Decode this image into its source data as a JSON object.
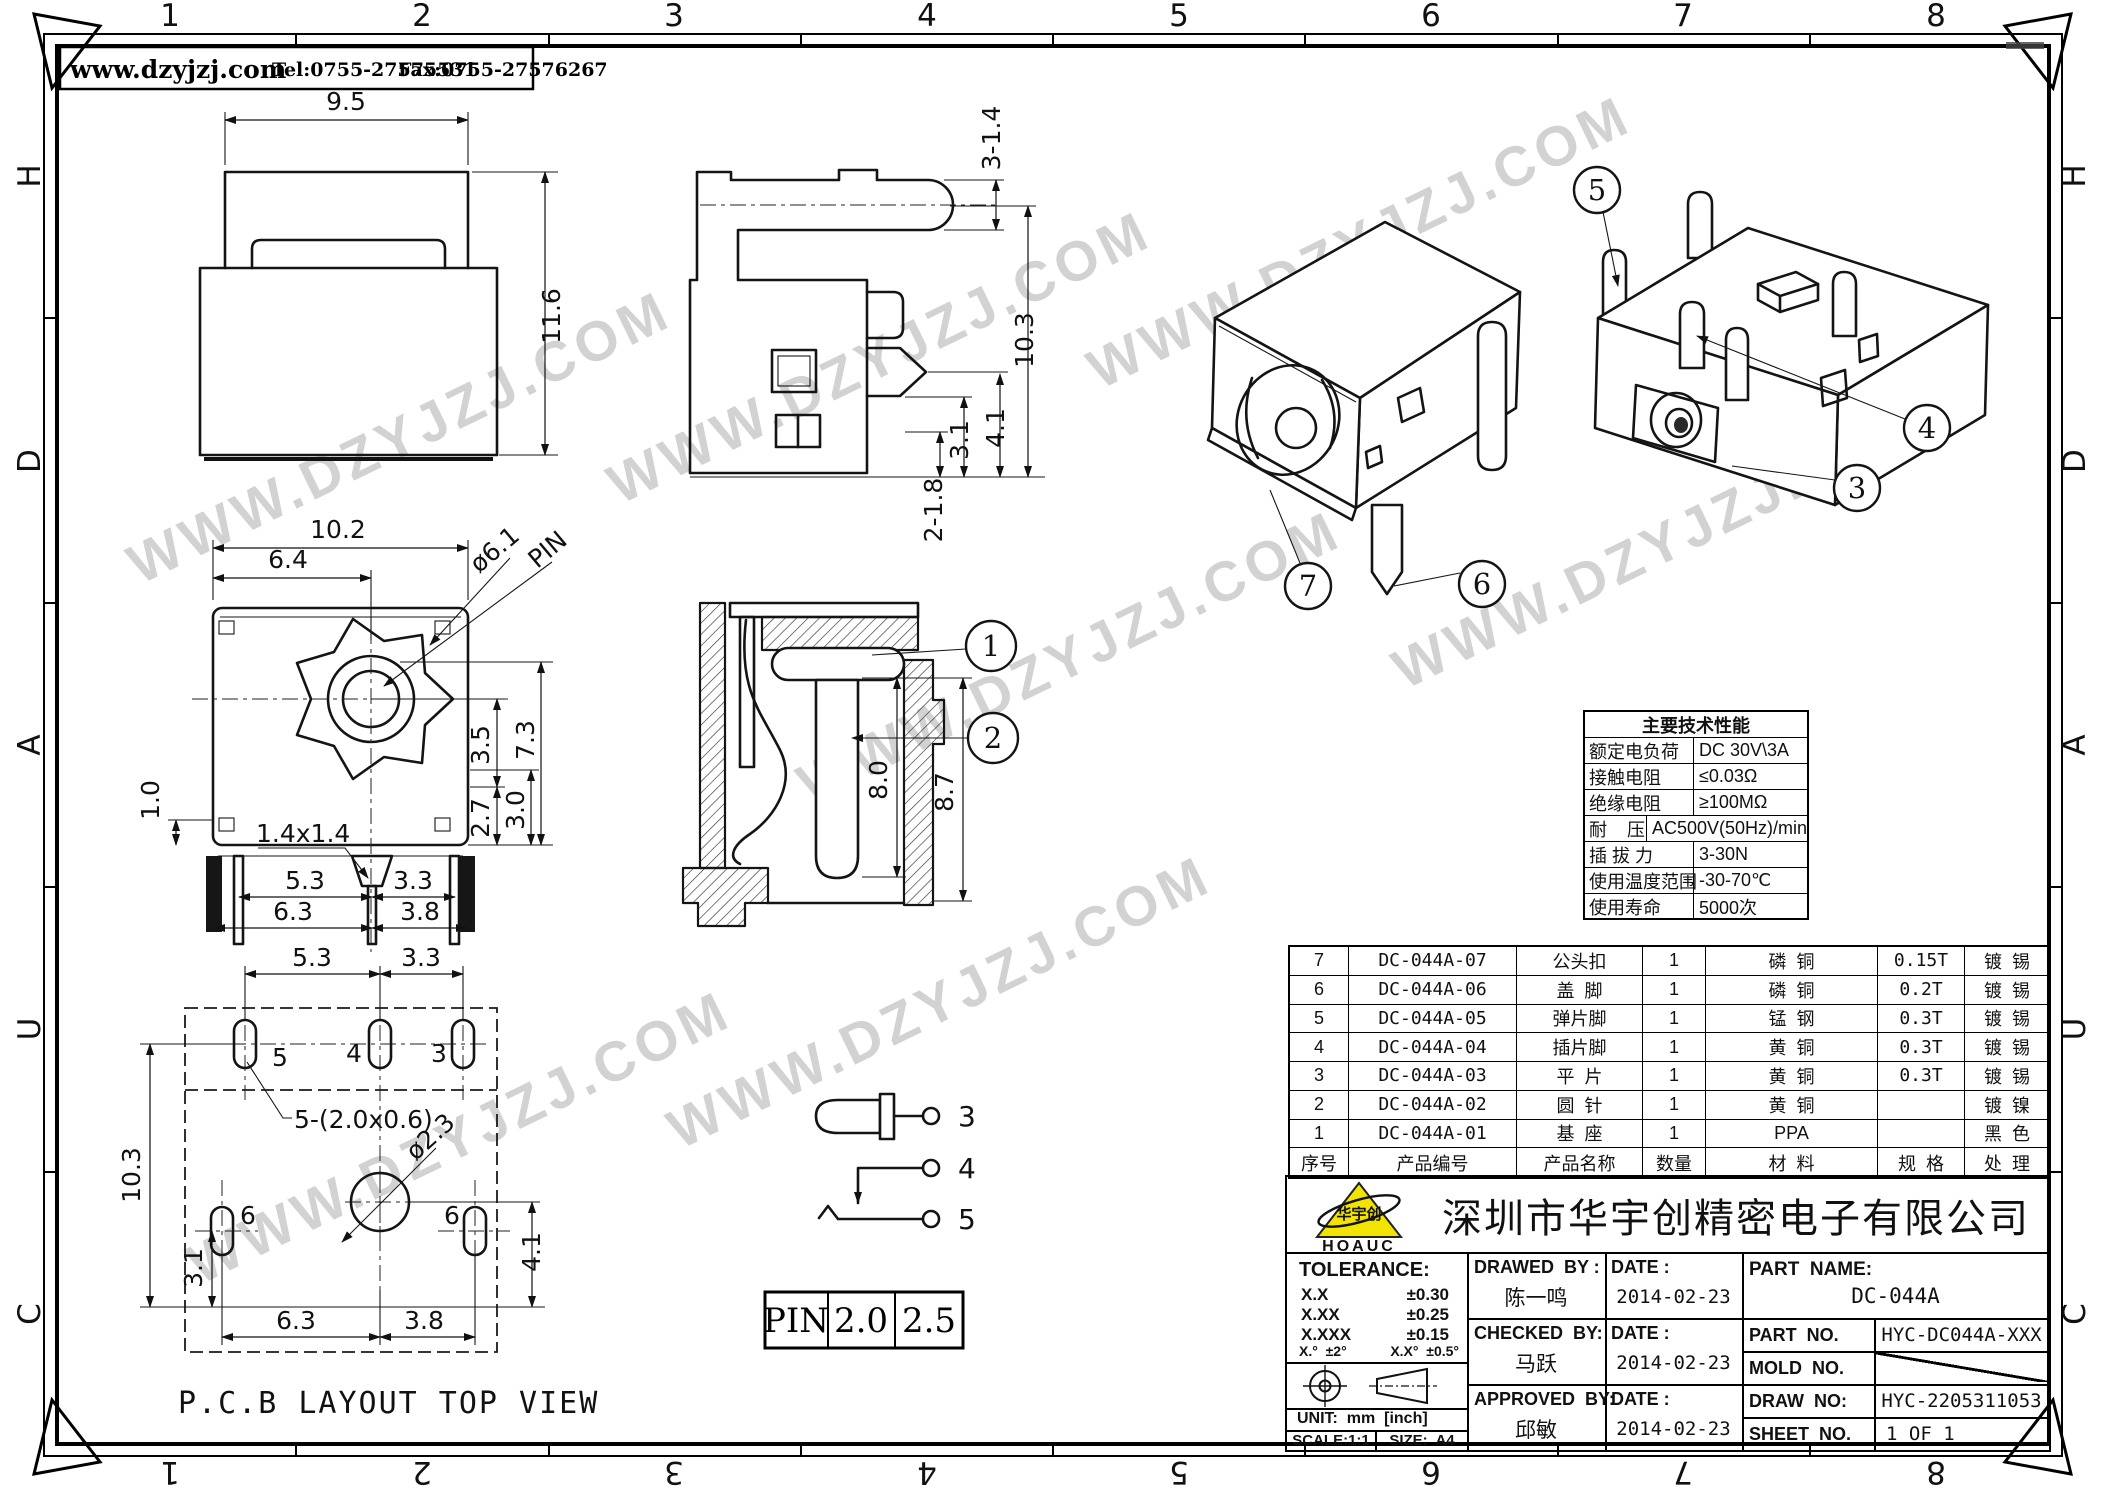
{
  "meta": {
    "site": "www.dzyjzj.com",
    "tel": "Tel:0755-27575531",
    "fax": "Fax:0755-27576267"
  },
  "border": {
    "cols": [
      "1",
      "2",
      "3",
      "4",
      "5",
      "6",
      "7",
      "8"
    ],
    "rows": [
      "H",
      "D",
      "A",
      "U",
      "C"
    ]
  },
  "views": {
    "rear": {
      "w": "9.5",
      "h": "11.6"
    },
    "side": {
      "a": "3-1.4",
      "b": "10.3",
      "c": "4.1",
      "d": "3.1",
      "e": "2-1.8"
    },
    "front": {
      "w102": "10.2",
      "w64": "6.4",
      "dia": "ø6.1",
      "pin": "PIN",
      "h73": "7.3",
      "h35": "3.5",
      "h30": "3.0",
      "h27": "2.7",
      "h10": "1.0",
      "pinsq": "1.4x1.4",
      "b53": "5.3",
      "b33": "3.3",
      "b63": "6.3",
      "b38": "3.8"
    },
    "pcb": {
      "t53": "5.3",
      "t33": "3.3",
      "h103": "10.3",
      "h31": "3.1",
      "b63": "6.3",
      "b38": "3.8",
      "r41": "4.1",
      "slot": "5-(2.0x0.6)",
      "hole": "ø2.3",
      "p5": "5",
      "p4": "4",
      "p3": "3",
      "p6a": "6",
      "p6b": "6",
      "title": "P.C.B LAYOUT TOP VIEW"
    },
    "section": {
      "d80": "8.0",
      "d87": "8.7",
      "c1": "1",
      "c2": "2"
    },
    "iso": {
      "c3": "3",
      "c4": "4",
      "c5": "5",
      "c6": "6",
      "c7": "7"
    },
    "sch": {
      "t3": "3",
      "t4": "4",
      "t5": "5"
    },
    "pin_table": {
      "label": "PIN",
      "v1": "2.0",
      "v2": "2.5"
    }
  },
  "specs": {
    "title": "主要技术性能",
    "rows": [
      {
        "k": "额定电负荷",
        "v": "DC 30V\\3A"
      },
      {
        "k": "接触电阻",
        "v": "≤0.03Ω"
      },
      {
        "k": "绝缘电阻",
        "v": "≥100MΩ"
      },
      {
        "k": "耐    压",
        "v": "AC500V(50Hz)/min"
      },
      {
        "k": "插 拔 力",
        "v": "3-30N"
      },
      {
        "k": "使用温度范围",
        "v": "-30-70℃"
      },
      {
        "k": "使用寿命",
        "v": "5000次"
      }
    ]
  },
  "bom": {
    "header": [
      "序号",
      "产品编号",
      "产品名称",
      "数量",
      "材  料",
      "规  格",
      "处  理"
    ],
    "rows": [
      [
        "7",
        "DC-044A-07",
        "公头扣",
        "1",
        "磷  铜",
        "0.15T",
        "镀  锡"
      ],
      [
        "6",
        "DC-044A-06",
        "盖  脚",
        "1",
        "磷  铜",
        "0.2T",
        "镀  锡"
      ],
      [
        "5",
        "DC-044A-05",
        "弹片脚",
        "1",
        "锰  钢",
        "0.3T",
        "镀  锡"
      ],
      [
        "4",
        "DC-044A-04",
        "插片脚",
        "1",
        "黄  铜",
        "0.3T",
        "镀  锡"
      ],
      [
        "3",
        "DC-044A-03",
        "平  片",
        "1",
        "黄  铜",
        "0.3T",
        "镀  锡"
      ],
      [
        "2",
        "DC-044A-02",
        "圆  针",
        "1",
        "黄  铜",
        "",
        "镀  镍"
      ],
      [
        "1",
        "DC-044A-01",
        "基  座",
        "1",
        "PPA",
        "",
        "黑  色"
      ]
    ]
  },
  "title_block": {
    "logo_text": "HOAUC",
    "logo_cn": "华宇创",
    "company": "深圳市华宇创精密电子有限公司",
    "tolerance_label": "TOLERANCE:",
    "tol1k": "X.X",
    "tol1v": "±0.30",
    "tol2k": "X.XX",
    "tol2v": "±0.25",
    "tol3k": "X.XXX",
    "tol3v": "±0.15",
    "tol_ang1": "X.°  ±2°",
    "tol_ang2": "X.X°  ±0.5°",
    "unit": "UNIT:  mm  [inch]",
    "scale": "SCALE:1:1",
    "size": "SIZE:  A4",
    "drawed_label": "DRAWED  BY :",
    "drawed": "陈一鸣",
    "checked_label": "CHECKED  BY:",
    "checked": "马跃",
    "approved_label": "APPROVED  BY:",
    "approved": "邱敏",
    "date_label": "DATE :",
    "date1": "2014-02-23",
    "date2": "2014-02-23",
    "date3": "2014-02-23",
    "part_name_label": "PART  NAME:",
    "part_name": "DC-044A",
    "part_no_label": "PART  NO.",
    "part_no": "HYC-DC044A-XXX",
    "mold_no_label": "MOLD  NO.",
    "draw_no_label": "DRAW  NO:",
    "draw_no": "HYC-2205311053",
    "sheet_no_label": "SHEET  NO.",
    "sheet_no": "1 OF 1"
  },
  "watermark": "WWW.DZYJZJ.COM"
}
